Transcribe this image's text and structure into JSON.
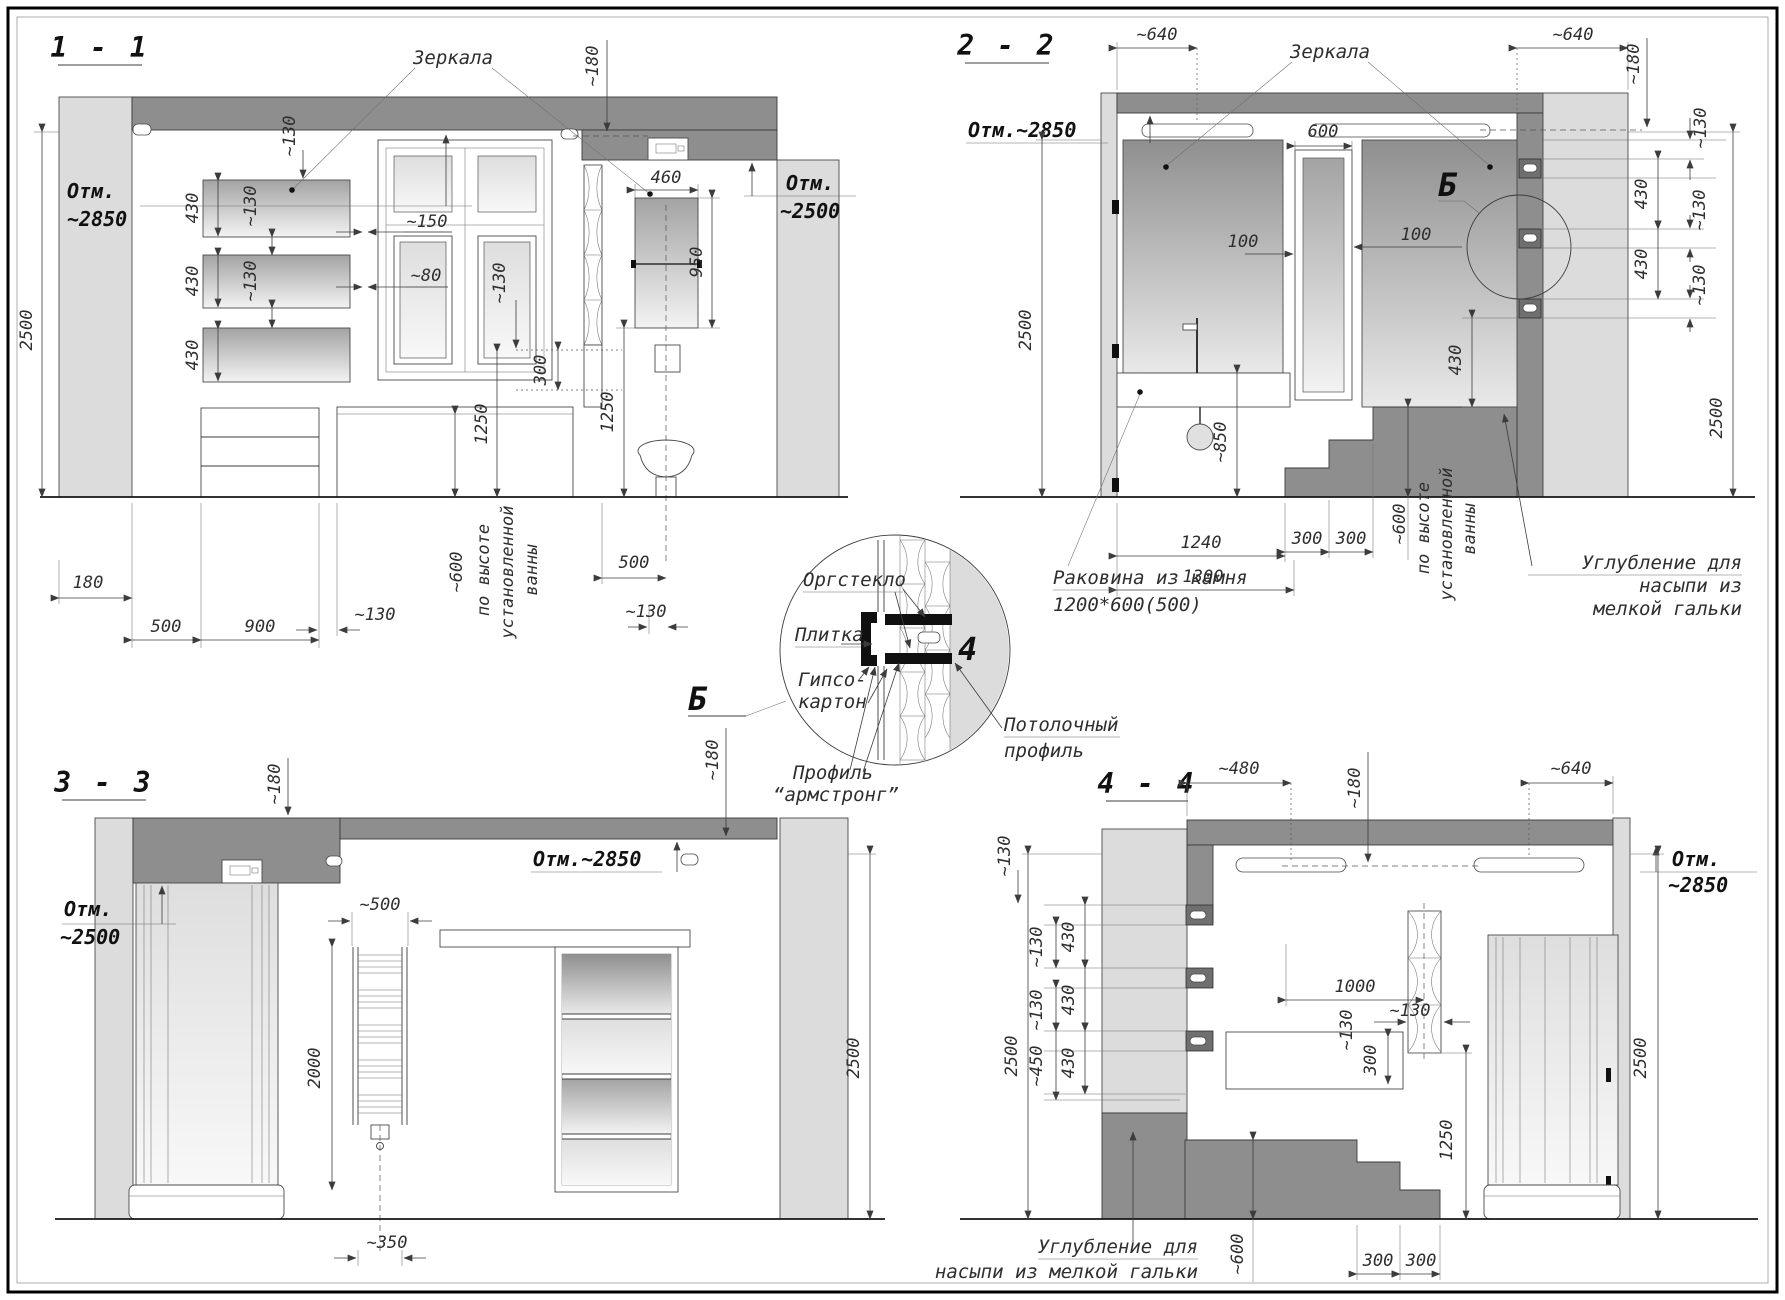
{
  "palette": {
    "soffit": "#8e8e8e",
    "column": "#dcdcdc",
    "line": "#3c3c3c",
    "background": "#ffffff"
  },
  "sections": {
    "s1": {
      "title": "1 - 1",
      "mirrors_label": "Зеркала",
      "elev_high": {
        "l1": "Отм.",
        "l2": "~2850"
      },
      "elev_low": {
        "l1": "Отм.",
        "l2": "~2500"
      },
      "dims": {
        "height": "2500",
        "gap_top": "~130",
        "m1_h": "430",
        "m1_gap": "~130",
        "m2_h": "430",
        "m2_gap": "~130",
        "m3_h": "430",
        "win_gap1": "~150",
        "win_gap2": "~80",
        "win_drop": "~130",
        "win_ref": "300",
        "ceil_drop": "~180",
        "mir_w": "460",
        "mir_h": "950",
        "h1250a": "1250",
        "h1250b": "1250",
        "b180": "180",
        "b500a": "500",
        "b900": "900",
        "b130a": "~130",
        "bath_h": "~600",
        "bath_t1": "по высоте",
        "bath_t2": "установленной",
        "bath_t3": "ванны",
        "b500b": "500",
        "b130b": "~130"
      }
    },
    "s2": {
      "title": "2 - 2",
      "mirrors_label": "Зеркала",
      "elev": "Отм.~2850",
      "detail_mark": "Б",
      "sink_label1": "Раковина из камня",
      "sink_label2": "1200*600(500)",
      "recess": [
        "Углубление для",
        "насыпи из",
        "мелкой гальки"
      ],
      "dims": {
        "t640l": "~640",
        "t640r": "~640",
        "t180": "~180",
        "t130": "~130",
        "m600": "600",
        "g100l": "100",
        "g100r": "100",
        "n430a": "430",
        "n130a": "~130",
        "n430b": "430",
        "n130b": "~130",
        "n430c": "430",
        "h2500l": "2500",
        "h2500r": "2500",
        "sink_h": "~850",
        "b1240": "1240",
        "b1300": "1300",
        "b300a": "300",
        "b300b": "300",
        "bath_h": "~600",
        "bath_t1": "по высоте",
        "bath_t2": "установленной",
        "bath_t3": "ванны"
      }
    },
    "s3": {
      "title": "3 - 3",
      "elev_mid": "Отм.~2850",
      "elev_low": {
        "l1": "Отм.",
        "l2": "~2500"
      },
      "dims": {
        "t180a": "~180",
        "t180b": "~180",
        "rail_w": "~500",
        "rail_h": "2000",
        "height": "2500",
        "rail_off": "~350"
      }
    },
    "s4": {
      "title": "4 - 4",
      "elev": {
        "l1": "Отм.",
        "l2": "~2850"
      },
      "recess": [
        "Углубление для",
        "насыпи из мелкой гальки"
      ],
      "dims": {
        "t480": "~480",
        "t180": "~180",
        "t640": "~640",
        "l130a": "~130",
        "l130b": "~130",
        "l430a": "430",
        "l130c": "~130",
        "l430b": "430",
        "l450": "~450",
        "l430c": "430",
        "h2500l": "2500",
        "h2500r": "2500",
        "w1000": "1000",
        "s130a": "~130",
        "s130b": "~130",
        "n300": "300",
        "h1250": "1250",
        "b300a": "300",
        "b300b": "300",
        "b600": "~600"
      }
    }
  },
  "detail": {
    "mark": "Б",
    "num": "4",
    "labels": {
      "plexi": "Оргстекло",
      "tile": "Плитка",
      "gips1": "Гипсо-",
      "gips2": "картон",
      "ceil1": "Потолочный",
      "ceil2": "профиль",
      "arm1": "Профиль",
      "arm2": "“армстронг”"
    }
  }
}
